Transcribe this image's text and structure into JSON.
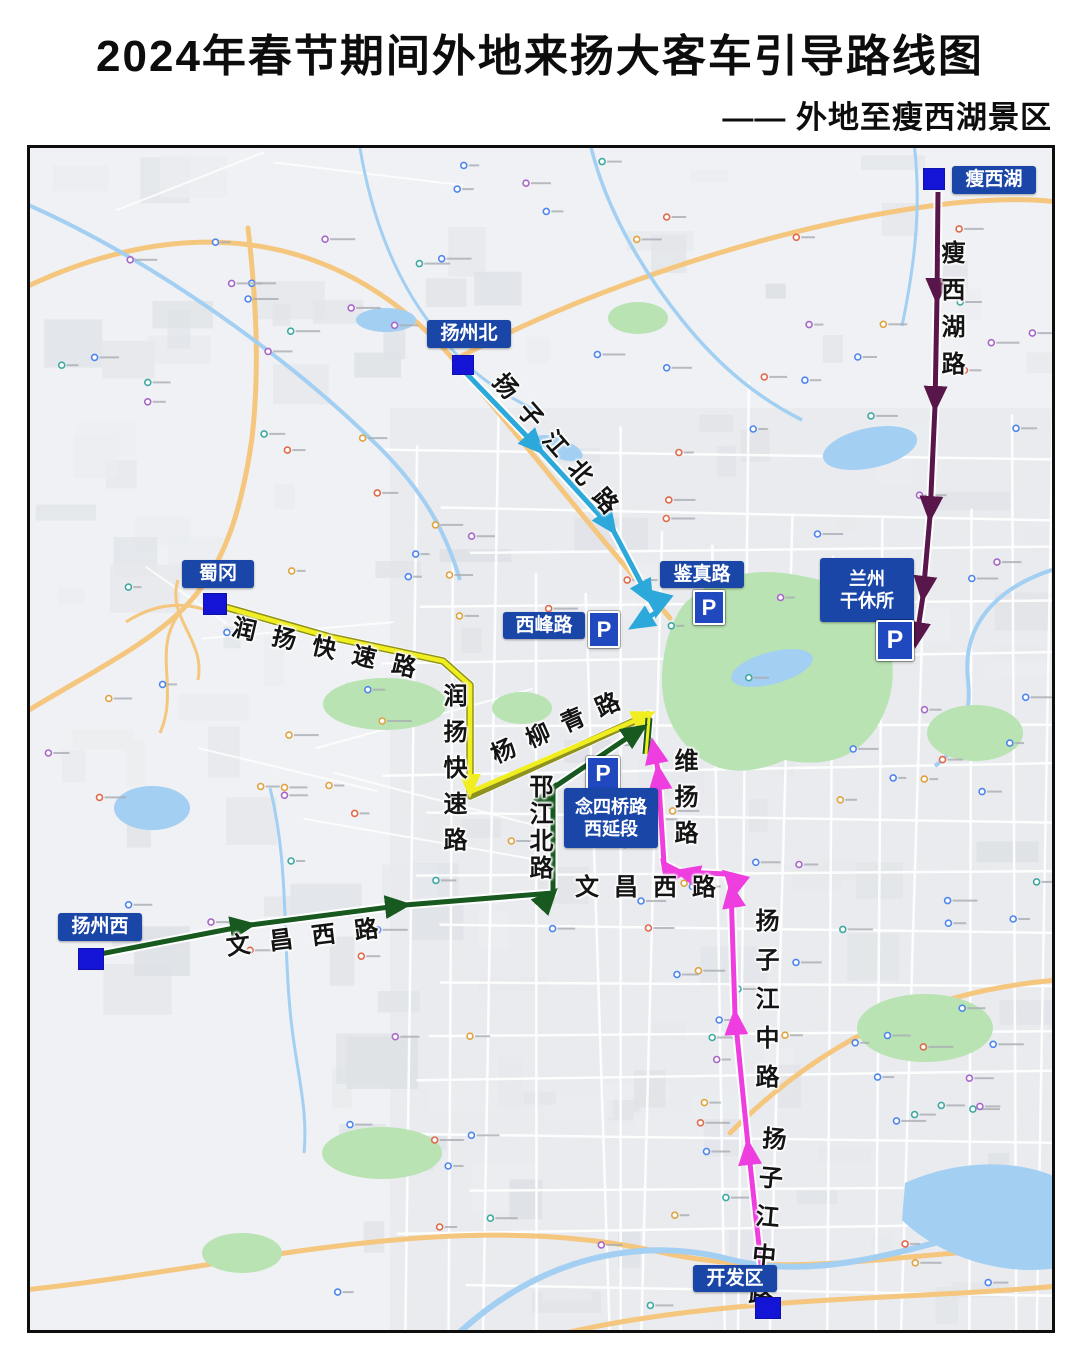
{
  "header": {
    "title": "2024年春节期间外地来扬大客车引导路线图",
    "subtitle": "—— 外地至瘦西湖景区"
  },
  "legend": {
    "title": "图　例",
    "station_symbol_label": "扬州",
    "station_desc": "高速收费站",
    "parking_symbol_label": "停车场",
    "parking_desc": "停车场地",
    "parking_letter": "P",
    "routes": [
      {
        "name": "瘦西湖收费站至兰州军区干休所停车场",
        "color": "#58164a",
        "label_line1": "瘦西湖收费站至兰州",
        "label_line2": "军区干休所停车场"
      },
      {
        "name": "开发区收费站至念四桥路西延段停车场",
        "color": "#ee3edf",
        "label_line1": "开发区收费站至念四",
        "label_line2": "桥路西延段停车场"
      },
      {
        "name": "扬州西收费站至念四桥路西延段停车场",
        "color": "#17591f",
        "label_line1": "扬州西收费站至念四",
        "label_line2": "桥路西延段停车场"
      },
      {
        "name": "蜀冈收费站至念四桥路西延段停车场",
        "color": "#f1ee20",
        "label_line1": "蜀冈收费站至念四",
        "label_line2": "桥路西延段停车场"
      },
      {
        "name": "扬州北收费站至鉴真路（西峰路）停车场",
        "color": "#2da8da",
        "label_line1": "扬州北收费站至鉴真",
        "label_line2": "路（西峰路）停车场"
      }
    ]
  },
  "stations": {
    "shouxihu": "瘦西湖",
    "yangzhoubei": "扬州北",
    "shugang": "蜀冈",
    "yangzhouxi": "扬州西",
    "kaifaqu": "开发区"
  },
  "parkings": {
    "letter": "P",
    "jianzhenlu": "鉴真路",
    "xifenglu": "西峰路",
    "lanzhou_line1": "兰州",
    "lanzhou_line2": "干休所",
    "niansiqiao_line1": "念四桥路",
    "niansiqiao_line2": "西延段"
  },
  "roads": {
    "shouxihulu": "瘦西湖路",
    "yangzijiang_beilu": "扬子江北路",
    "runyang_kuaisulu_h": "润扬快速路",
    "runyang_kuaisulu_v": "润扬快速路",
    "yangliuqinglu": "杨柳青路",
    "hanjiang_beilu": "邗江北路",
    "weiyanglu": "维扬路",
    "wenchang_xilu_w": "文昌西路",
    "wenchang_xilu_e": "文昌西路",
    "yangzijiang_zhonglu_n": "扬子江中路",
    "yangzijiang_zhonglu_s": "扬子江中路"
  },
  "colors": {
    "label_blue": "#1a46a8",
    "toll_blue": "#1414d6",
    "p_blue": "#2049bf"
  }
}
